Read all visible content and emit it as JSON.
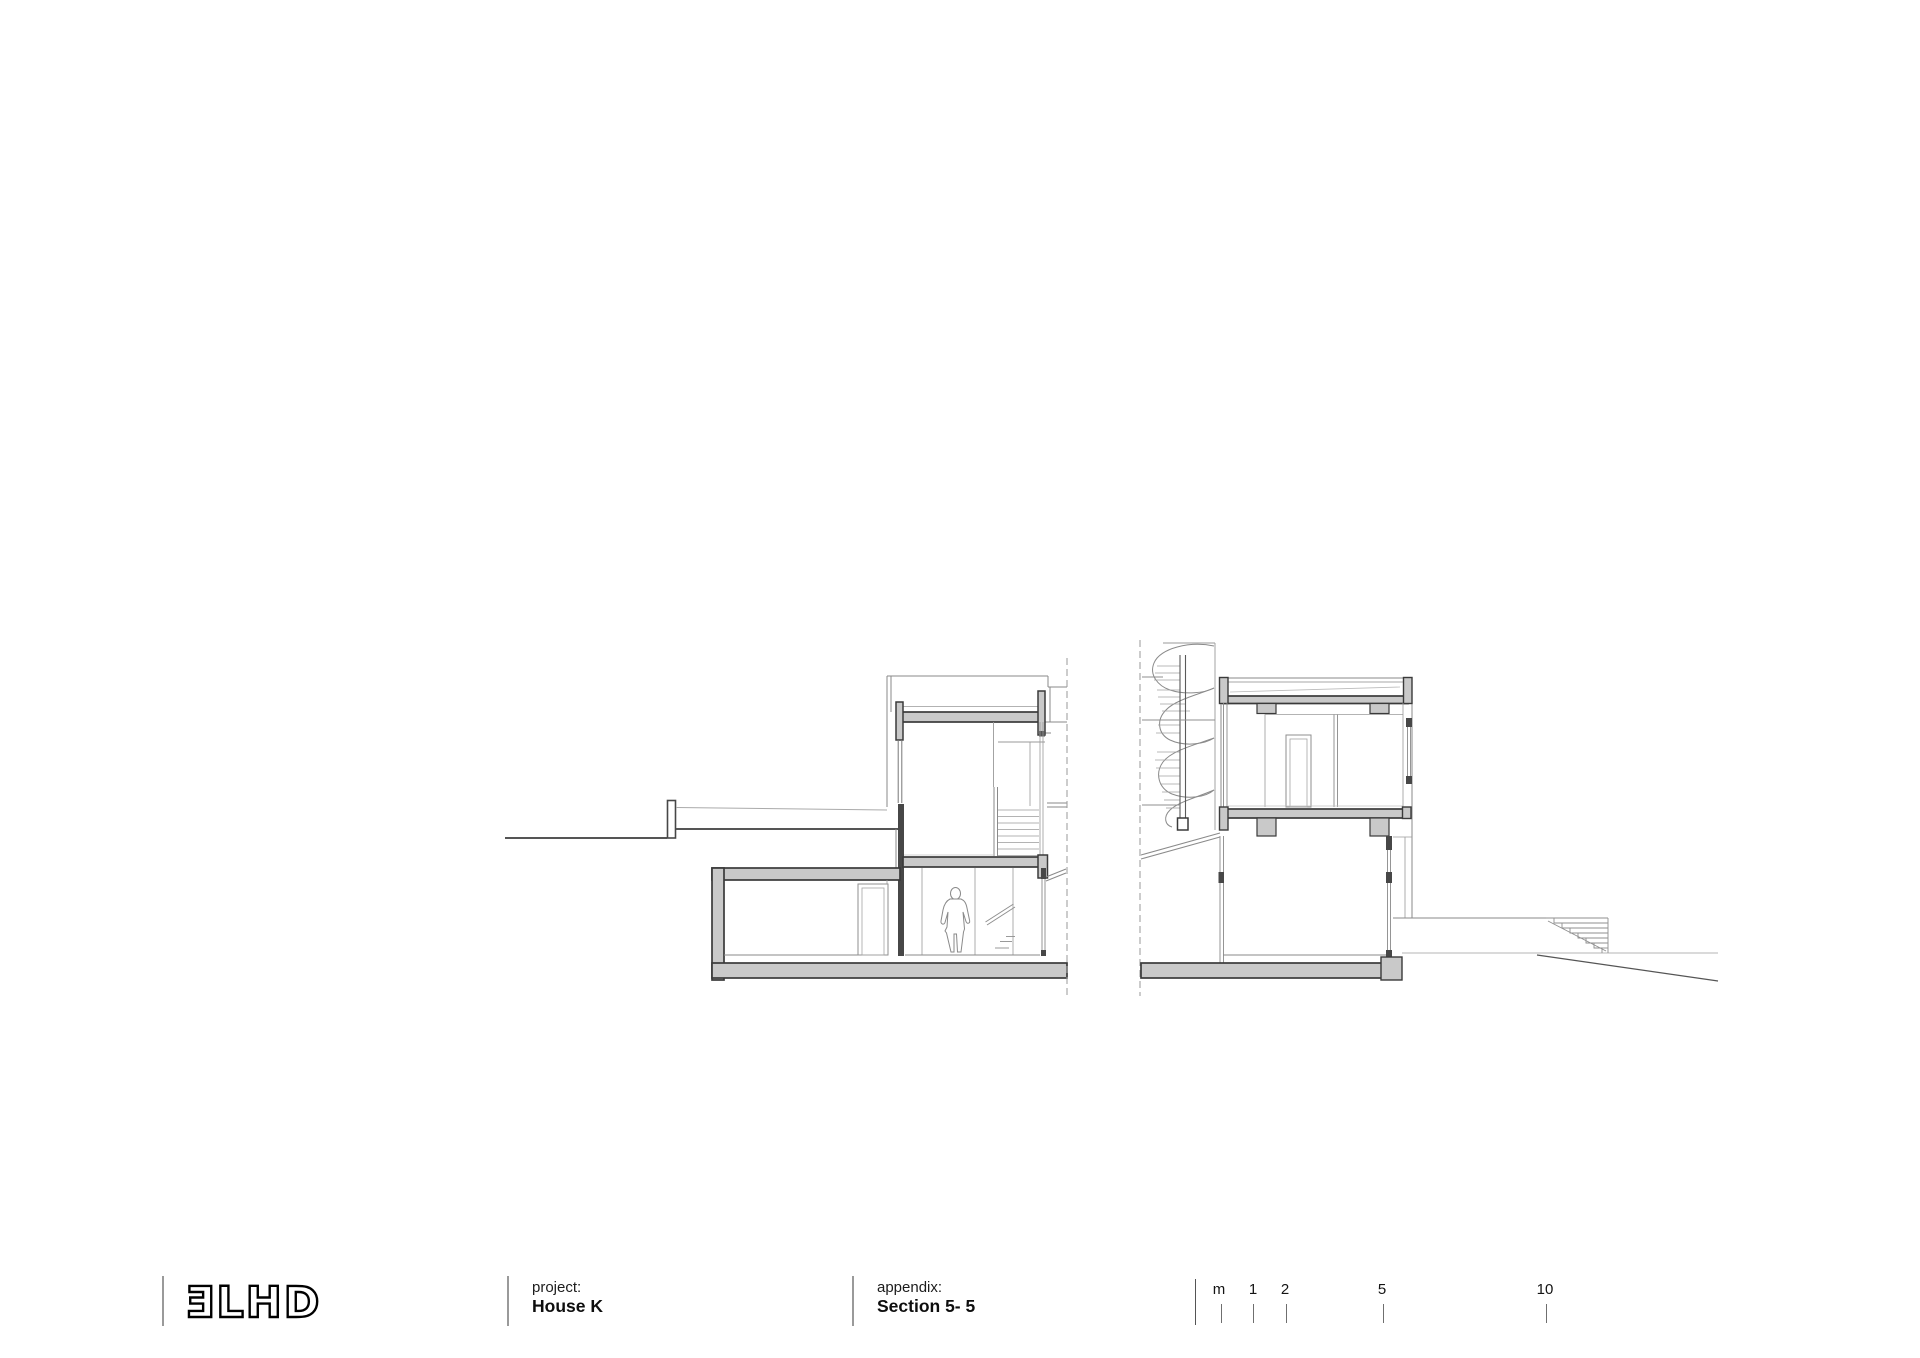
{
  "drawing": {
    "name": "architectural cross-section of House K, two building volumes with spiral staircase, split by section break lines",
    "type": "architectural-section-drawing",
    "colors": {
      "background": "#ffffff",
      "cut_outline": "#3a3a3a",
      "cut_fill": "#c9c9c9",
      "solid_cut_fill": "#474747",
      "thin_line": "#8a8a8a",
      "ground_line": "#555555"
    }
  },
  "footer": {
    "logo": {
      "display": "ƎLHD",
      "brand": "3LHD"
    },
    "project": {
      "label": "project:",
      "value": "House K"
    },
    "appendix": {
      "label": "appendix:",
      "value": "Section 5- 5"
    },
    "scale_bar": {
      "marks": [
        "m",
        "1",
        "2",
        "5",
        "10"
      ]
    }
  }
}
